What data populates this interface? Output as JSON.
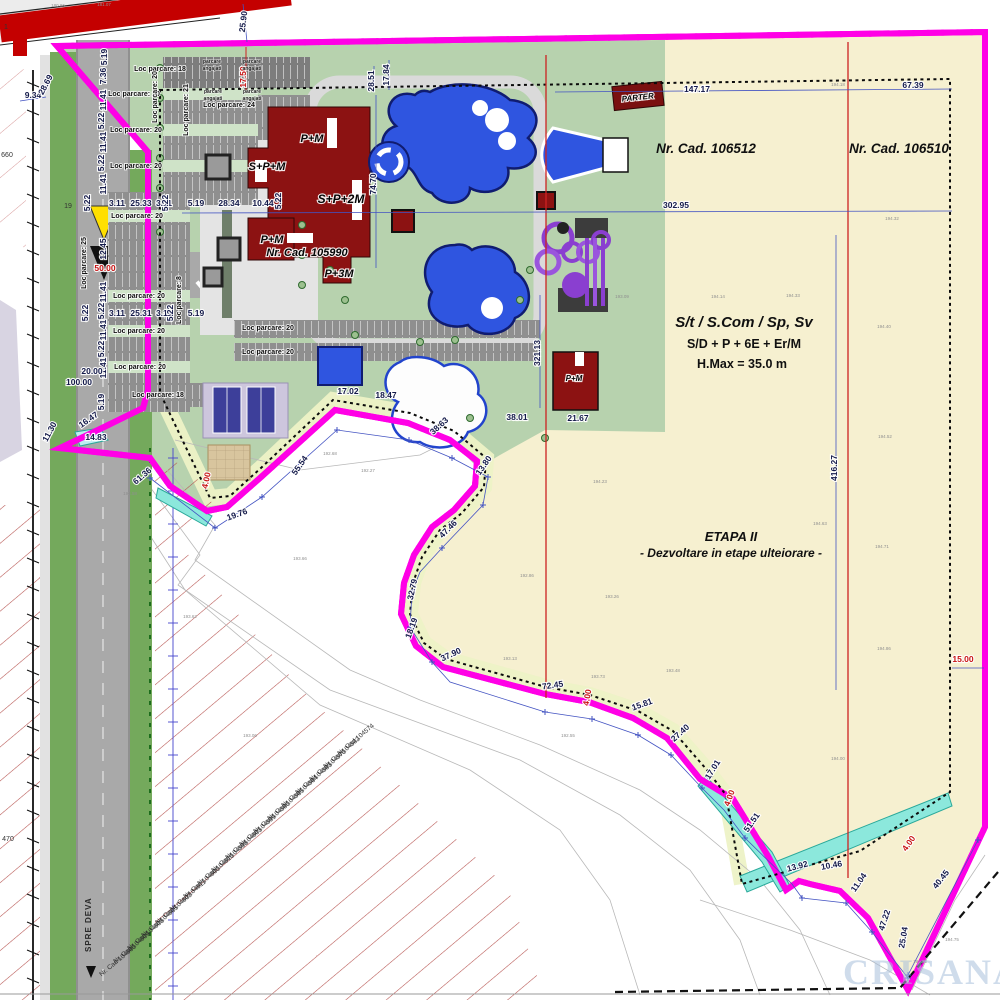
{
  "zone": {
    "nrcad_left": "Nr. Cad. 106512",
    "nrcad_right": "Nr. Cad. 106510",
    "nrcad_building": "Nr. Cad. 105990",
    "regime_line1": "S/t / S.Com / Sp, Sv",
    "regime_line2": "S/D + P + 6E + Er/M",
    "regime_line3": "H.Max = 35.0 m",
    "etapa_line1": "ETAPA II",
    "etapa_line2": "- Dezvoltare in etape ulteiorare -"
  },
  "watermark": "CRISANA",
  "road_direction": "SPRE DEVA",
  "labels": {
    "dims": [
      [
        "25.90",
        246,
        22,
        -83
      ],
      [
        "9.34",
        33,
        98,
        0
      ],
      [
        "28.69",
        48,
        86,
        -62
      ],
      [
        "5.19",
        107,
        57,
        -90
      ],
      [
        "7.36",
        106,
        76,
        -90
      ],
      [
        "11.41",
        106,
        100,
        -90
      ],
      [
        "5.22",
        104,
        121,
        -90
      ],
      [
        "11.41",
        106,
        142,
        -90
      ],
      [
        "5.22",
        104,
        163,
        -90
      ],
      [
        "11.41",
        106,
        184,
        -90
      ],
      [
        "5.22",
        90,
        203,
        -90
      ],
      [
        "3.11",
        117,
        206,
        0
      ],
      [
        "25.33",
        141,
        206,
        0
      ],
      [
        "3.11",
        164,
        206,
        0
      ],
      [
        "5.22",
        168,
        203,
        -90
      ],
      [
        "5.19",
        196,
        206,
        0
      ],
      [
        "28.34",
        229,
        206,
        0
      ],
      [
        "10.44",
        263,
        206,
        0
      ],
      [
        "5.22",
        281,
        201,
        -90
      ],
      [
        "12.45",
        106,
        249,
        -90
      ],
      [
        "11.41",
        106,
        292,
        -90
      ],
      [
        "5.22",
        104,
        311,
        -90
      ],
      [
        "11.41",
        106,
        330,
        -90
      ],
      [
        "5.22",
        104,
        349,
        -90
      ],
      [
        "11.41",
        106,
        368,
        -90
      ],
      [
        "3.11",
        117,
        316,
        0
      ],
      [
        "25.31",
        141,
        316,
        0
      ],
      [
        "3.11",
        164,
        316,
        0
      ],
      [
        "5.22",
        88,
        313,
        -90
      ],
      [
        "5.22",
        173,
        313,
        -90
      ],
      [
        "5.19",
        196,
        316,
        0
      ],
      [
        "20.00",
        92,
        374,
        0
      ],
      [
        "100.00",
        79,
        385,
        0
      ],
      [
        "5.19",
        104,
        402,
        -90
      ],
      [
        "17.84",
        389,
        75,
        -90
      ],
      [
        "28.51",
        374,
        81,
        -90
      ],
      [
        "74.70",
        376,
        184,
        -90
      ],
      [
        "147.17",
        697,
        92,
        0
      ],
      [
        "67.39",
        913,
        88,
        0
      ],
      [
        "302.95",
        676,
        208,
        0
      ],
      [
        "321.13",
        540,
        353,
        -90
      ],
      [
        "416.27",
        837,
        468,
        -90
      ],
      [
        "17.02",
        348,
        394,
        0
      ],
      [
        "18.47",
        386,
        398,
        0
      ],
      [
        "38.63",
        441,
        428,
        -42
      ],
      [
        "38.01",
        517,
        420,
        0
      ],
      [
        "21.67",
        578,
        421,
        0
      ],
      [
        "13.80",
        486,
        467,
        -55
      ],
      [
        "47.46",
        450,
        531,
        -45
      ],
      [
        "32.79",
        415,
        590,
        -78
      ],
      [
        "18.19",
        414,
        629,
        -70
      ],
      [
        "37.90",
        452,
        657,
        -25
      ],
      [
        "72.45",
        553,
        688,
        -8
      ],
      [
        "15.81",
        643,
        707,
        -20
      ],
      [
        "27.40",
        682,
        735,
        -42
      ],
      [
        "17.01",
        715,
        771,
        -58
      ],
      [
        "51.51",
        754,
        824,
        -55
      ],
      [
        "13.92",
        798,
        869,
        -15
      ],
      [
        "10.46",
        832,
        868,
        -10
      ],
      [
        "11.04",
        861,
        884,
        -55
      ],
      [
        "47.22",
        887,
        921,
        -72
      ],
      [
        "25.04",
        906,
        938,
        -80
      ],
      [
        "40.45",
        943,
        881,
        -52
      ],
      [
        "19.76",
        238,
        517,
        -20
      ],
      [
        "55.54",
        302,
        467,
        -55
      ],
      [
        "14.83",
        96,
        440,
        0
      ],
      [
        "16.47",
        90,
        422,
        -35
      ],
      [
        "11.30",
        52,
        433,
        -62
      ],
      [
        "61.36",
        144,
        478,
        -40
      ]
    ],
    "dims_red": [
      [
        "17.50",
        246,
        77,
        -90
      ],
      [
        "50.00",
        105,
        271,
        0
      ],
      [
        "4.00",
        209,
        481,
        -78
      ],
      [
        "4.00",
        590,
        698,
        -80
      ],
      [
        "4.00",
        732,
        799,
        -70
      ],
      [
        "4.00",
        911,
        845,
        -55
      ],
      [
        "15.00",
        963,
        662,
        0
      ]
    ],
    "parking": [
      [
        "Loc parcare: 18",
        160,
        71,
        0
      ],
      [
        "Loc parcare: 24",
        229,
        107,
        0
      ],
      [
        "Loc parcare: 20",
        134,
        96,
        0
      ],
      [
        "Loc parcare: 20",
        136,
        132,
        0
      ],
      [
        "Loc parcare: 20",
        136,
        168,
        0
      ],
      [
        "Loc parcare: 20",
        137,
        218,
        0
      ],
      [
        "Loc parcare: 20",
        139,
        298,
        0
      ],
      [
        "Loc parcare: 20",
        139,
        333,
        0
      ],
      [
        "Loc parcare: 20",
        140,
        369,
        0
      ],
      [
        "Loc parcare: 18",
        158,
        397,
        0
      ],
      [
        "Loc parcare: 20",
        268,
        330,
        0
      ],
      [
        "Loc parcare: 20",
        268,
        354,
        0
      ],
      [
        "Loc parcare: 25",
        86,
        263,
        -90
      ],
      [
        "Loc parcare: 21",
        188,
        110,
        -90
      ],
      [
        "Loc parcare: 8",
        181,
        300,
        -90
      ],
      [
        "Loc parcare: 20",
        157,
        97,
        -90
      ]
    ],
    "angajati": [
      [
        "parcare",
        212,
        63,
        0
      ],
      [
        "angajati",
        212,
        70,
        0
      ],
      [
        "parcare",
        252,
        63,
        0
      ],
      [
        "angajati",
        252,
        70,
        0
      ],
      [
        "parcare",
        213,
        93,
        0
      ],
      [
        "angajati",
        213,
        100,
        0
      ],
      [
        "parcare",
        252,
        93,
        0
      ],
      [
        "angajati",
        252,
        100,
        0
      ]
    ],
    "buildings": [
      [
        "P+M",
        312,
        142,
        0,
        11
      ],
      [
        "S+P+M",
        267,
        170,
        0,
        11
      ],
      [
        "S+P+2M",
        341,
        203,
        0,
        12
      ],
      [
        "P+M",
        272,
        243,
        0,
        11
      ],
      [
        "Nr. Cad. 105990",
        307,
        256,
        0,
        11
      ],
      [
        "P+3M",
        339,
        277,
        0,
        11
      ],
      [
        "PARTER",
        638,
        100,
        -6,
        8
      ],
      [
        "P+M",
        574,
        381,
        0,
        8
      ]
    ],
    "cads": [
      [
        "Nr. Cad 104574",
        357,
        741,
        -40
      ],
      [
        "Nr. Cad 104582",
        343,
        754,
        -40
      ],
      [
        "Nr. Cad 104570",
        329,
        767,
        -40
      ],
      [
        "Nr. Cad 104583",
        315,
        780,
        -40
      ],
      [
        "Nr. Cad 104564",
        301,
        793,
        -40
      ],
      [
        "Nr. Cad 104565",
        287,
        806,
        -40
      ],
      [
        "Nr. Cad 104580",
        273,
        819,
        -40
      ],
      [
        "Nr. Cad 104599",
        259,
        832,
        -40
      ],
      [
        "Nr. Cad 104603",
        245,
        845,
        -40
      ],
      [
        "Nr. Cad 104598",
        231,
        858,
        -40
      ],
      [
        "Nr. Cad 104610",
        217,
        871,
        -40
      ],
      [
        "Nr. Cad 104600",
        203,
        884,
        -40
      ],
      [
        "Nr. Cad 104611",
        189,
        897,
        -40
      ],
      [
        "Nr. Cad 104602",
        175,
        910,
        -40
      ],
      [
        "Nr. Cad 104605",
        161,
        923,
        -40
      ],
      [
        "Nr. Cad 104608",
        147,
        936,
        -40
      ],
      [
        "Nr. Cad 104609",
        133,
        949,
        -40
      ],
      [
        "Nr. Cad 104660",
        119,
        962,
        -40
      ]
    ],
    "elev": [
      [
        "180.86",
        58,
        7,
        0
      ],
      [
        "181.07",
        104,
        6,
        0
      ],
      [
        "194.18",
        838,
        86,
        0
      ],
      [
        "194.32",
        892,
        220,
        0
      ],
      [
        "194.40",
        884,
        328,
        0
      ],
      [
        "194.52",
        885,
        438,
        0
      ],
      [
        "194.71",
        882,
        548,
        0
      ],
      [
        "194.86",
        884,
        650,
        0
      ],
      [
        "194.00",
        838,
        760,
        0
      ],
      [
        "193.09",
        622,
        298,
        0
      ],
      [
        "194.14",
        718,
        298,
        0
      ],
      [
        "194.33",
        793,
        297,
        0
      ],
      [
        "194.23",
        600,
        483,
        0
      ],
      [
        "192.86",
        527,
        577,
        0
      ],
      [
        "193.26",
        612,
        598,
        0
      ],
      [
        "193.73",
        598,
        678,
        0
      ],
      [
        "193.48",
        673,
        672,
        0
      ],
      [
        "193.13",
        510,
        660,
        0
      ],
      [
        "194.63",
        820,
        525,
        0
      ],
      [
        "193.62",
        190,
        618,
        0
      ],
      [
        "193.06",
        250,
        737,
        0
      ],
      [
        "193.58",
        130,
        495,
        0
      ],
      [
        "192.68",
        330,
        455,
        0
      ],
      [
        "193.66",
        300,
        560,
        0
      ],
      [
        "192.27",
        368,
        472,
        0
      ],
      [
        "192.55",
        568,
        737,
        0
      ],
      [
        "194.55",
        920,
        963,
        0
      ],
      [
        "194.75",
        952,
        941,
        0
      ]
    ],
    "misc": [
      [
        "1",
        6,
        29,
        0,
        9
      ],
      [
        "660",
        7,
        157,
        0,
        4.5
      ],
      [
        "470",
        8,
        841,
        0,
        4.5
      ],
      [
        "19",
        68,
        208,
        0,
        6
      ]
    ]
  }
}
